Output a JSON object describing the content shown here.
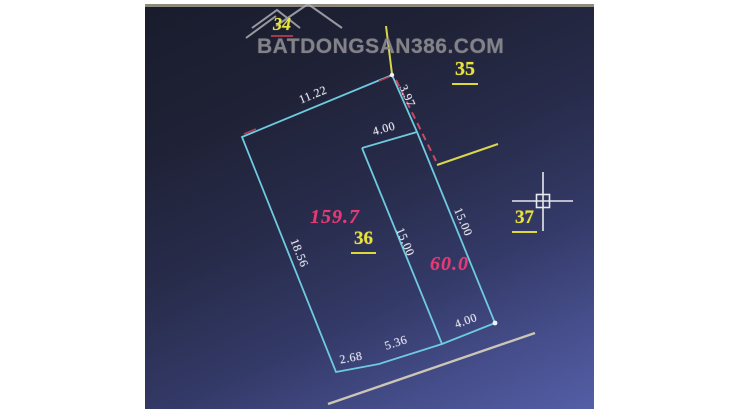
{
  "watermark": {
    "text": "BATDONGSAN386.COM"
  },
  "parcel_labels": {
    "p34": "34",
    "p35": "35",
    "p36": "36",
    "p37": "37"
  },
  "areas": {
    "lot36": "159.7",
    "lot60": "60.0"
  },
  "dimensions": {
    "top_edge": "11.22",
    "upper_right_edge": "3.97",
    "lot60_top_edge": "4.00",
    "divider_edge": "15.00",
    "right_edge": "15.00",
    "left_edge": "18.56",
    "lot60_bottom_edge": "4.00",
    "bottom_middle_edge": "5.36",
    "bottom_left_edge": "2.68"
  },
  "colors": {
    "parcel_line_cyan": "#6fcadf",
    "label_yellow": "#e9e23f",
    "area_pink": "#e63a75",
    "dashed_red": "#c84a62",
    "boundary_yellow": "#d9d74e",
    "watermark_gray": "#8b8b90",
    "road_line": "#ccc6b6",
    "dimension_text": "#e8e8f0",
    "background_top": "#191c2d",
    "background_bottom": "#545ea6"
  }
}
